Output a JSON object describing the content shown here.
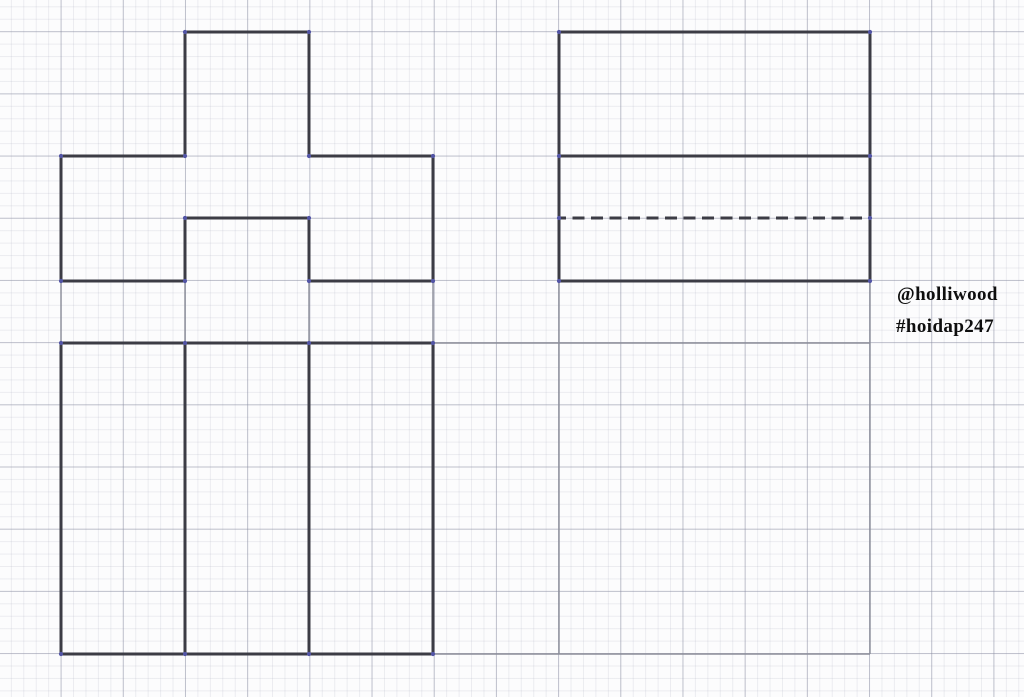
{
  "watermark": {
    "handle": "@holliwood",
    "hashtag": "#hoidap247"
  },
  "colors": {
    "paper_background": "#fcfcfd",
    "grid_minor": "#eaebf1",
    "grid_major": "#c9cbd4",
    "drawing_stroke": "#3c3c45",
    "projection_stroke": "#8b8d99",
    "vertex_dot": "#5254a5",
    "watermark_text": "#0e0e0e"
  },
  "grid": {
    "minor_step_px": 12.44,
    "major_step_px": 62.2,
    "major_offset_x_px": 61,
    "major_offset_y_px": 31
  },
  "drawing": {
    "canvas": {
      "width": 1024,
      "height": 697
    },
    "styles": {
      "thick": {
        "stroke": "#3c3c45",
        "width": 3
      },
      "dashed": {
        "stroke": "#3c3c45",
        "width": 3,
        "dasharray": "12 6.5",
        "dashoffset": 5
      },
      "thin": {
        "stroke": "#8b8d99",
        "width": 1.4
      }
    },
    "groups": [
      {
        "name": "front-view",
        "lines": [
          {
            "d": "M61 156 L185 156 L185 32 L309 32 L309 156 L433 156 L433 281 L309 281 L309 218 L185 218 L185 281 L61 281 Z",
            "kind": "thick"
          }
        ]
      },
      {
        "name": "side-view",
        "lines": [
          {
            "d": "M559 32 H870 V281 H559 Z",
            "kind": "thick"
          },
          {
            "d": "M559 156 H870",
            "kind": "thick"
          },
          {
            "d": "M559 218 H870",
            "kind": "dashed"
          }
        ]
      },
      {
        "name": "top-view",
        "lines": [
          {
            "d": "M61 343 H433 V654 H61 Z",
            "kind": "thick"
          },
          {
            "d": "M185 343 V654",
            "kind": "thick"
          },
          {
            "d": "M309 343 V654",
            "kind": "thick"
          }
        ]
      },
      {
        "name": "projection-lines",
        "lines": [
          {
            "d": "M61 281 V343",
            "kind": "thin"
          },
          {
            "d": "M185 281 V343",
            "kind": "thin"
          },
          {
            "d": "M309 281 V343",
            "kind": "thin"
          },
          {
            "d": "M433 281 V343",
            "kind": "thin"
          },
          {
            "d": "M559 281 V654",
            "kind": "thin"
          },
          {
            "d": "M870 281 V654",
            "kind": "thin"
          },
          {
            "d": "M433 343 H870",
            "kind": "thin"
          },
          {
            "d": "M433 654 H870",
            "kind": "thin"
          }
        ]
      }
    ],
    "vertices": {
      "radius": 2.1,
      "fill": "#5254a5",
      "points": [
        [
          61,
          156
        ],
        [
          185,
          156
        ],
        [
          185,
          32
        ],
        [
          309,
          32
        ],
        [
          309,
          156
        ],
        [
          433,
          156
        ],
        [
          433,
          281
        ],
        [
          309,
          281
        ],
        [
          309,
          218
        ],
        [
          185,
          218
        ],
        [
          185,
          281
        ],
        [
          61,
          281
        ],
        [
          559,
          32
        ],
        [
          870,
          32
        ],
        [
          559,
          156
        ],
        [
          870,
          156
        ],
        [
          559,
          218
        ],
        [
          870,
          218
        ],
        [
          559,
          281
        ],
        [
          870,
          281
        ],
        [
          61,
          343
        ],
        [
          185,
          343
        ],
        [
          309,
          343
        ],
        [
          433,
          343
        ],
        [
          61,
          654
        ],
        [
          185,
          654
        ],
        [
          309,
          654
        ],
        [
          433,
          654
        ]
      ]
    }
  }
}
